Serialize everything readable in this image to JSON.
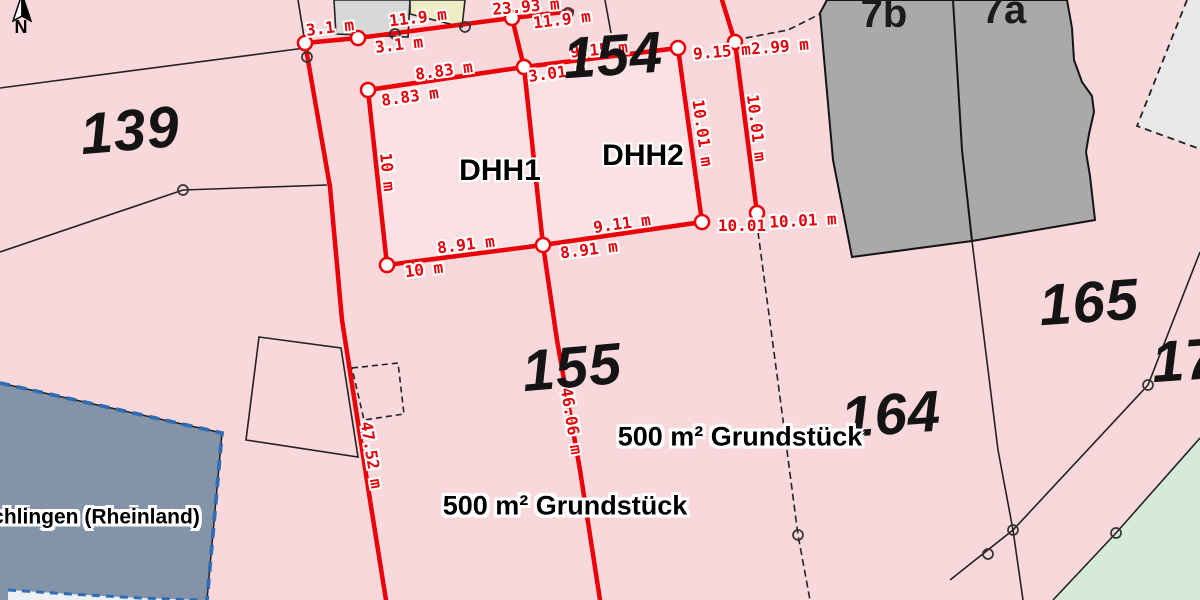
{
  "map": {
    "north_label": "N",
    "colors": {
      "background_pink": "#f9d8db",
      "parcel_highlight_pink": "#fbe1e3",
      "measurement_red": "#e60008",
      "building_gray": "#a9a9a9",
      "small_building_gray": "#d8d8d8",
      "yellow_building": "#ecebc3",
      "dashed_region_gray": "#e8e8e8",
      "green_area": "#d6ead8",
      "municipality_blue_fill": "#8494a8",
      "municipality_blue_border": "#2e6cb6",
      "boundary_black": "#222222",
      "inner_white_shape": "#eef1f3"
    },
    "labels": {
      "measurements": [
        {
          "text": "3.1 m",
          "x": 330,
          "y": 28,
          "rot": -7
        },
        {
          "text": "3.1 m",
          "x": 399,
          "y": 45,
          "rot": -7
        },
        {
          "text": "11.9 m",
          "x": 418,
          "y": 18,
          "rot": -7
        },
        {
          "text": "23.93 m",
          "x": 526,
          "y": 7,
          "rot": -5
        },
        {
          "text": "11.9 m",
          "x": 562,
          "y": 20,
          "rot": -7
        },
        {
          "text": "8.83 m",
          "x": 444,
          "y": 71,
          "rot": -8
        },
        {
          "text": "8.83 m",
          "x": 410,
          "y": 97,
          "rot": -8
        },
        {
          "text": "3.01 m",
          "x": 557,
          "y": 73,
          "rot": -8
        },
        {
          "text": "9.15 m",
          "x": 599,
          "y": 50,
          "rot": -5
        },
        {
          "text": "9.15 m",
          "x": 722,
          "y": 52,
          "rot": -5
        },
        {
          "text": "2.99 m",
          "x": 780,
          "y": 47,
          "rot": -5
        },
        {
          "text": "10 m",
          "x": 387,
          "y": 172,
          "rot": 84
        },
        {
          "text": "10.01 m",
          "x": 702,
          "y": 133,
          "rot": 82
        },
        {
          "text": "10.01 m",
          "x": 756,
          "y": 128,
          "rot": 83
        },
        {
          "text": "9.11 m",
          "x": 622,
          "y": 224,
          "rot": -8
        },
        {
          "text": "8.91 m",
          "x": 466,
          "y": 245,
          "rot": -7
        },
        {
          "text": "8.91 m",
          "x": 589,
          "y": 250,
          "rot": -7
        },
        {
          "text": "10 m",
          "x": 424,
          "y": 270,
          "rot": -7
        },
        {
          "text": "10.01",
          "x": 742,
          "y": 226,
          "rot": 0
        },
        {
          "text": "10.01 m",
          "x": 803,
          "y": 221,
          "rot": -3
        },
        {
          "text": "46.06 m",
          "x": 571,
          "y": 421,
          "rot": 81
        },
        {
          "text": "47.52 m",
          "x": 371,
          "y": 455,
          "rot": 81
        }
      ],
      "parcels": [
        {
          "text": "139",
          "x": 130,
          "y": 131,
          "rot": -5
        },
        {
          "text": "154",
          "x": 613,
          "y": 56,
          "rot": -4
        },
        {
          "text": "155",
          "x": 572,
          "y": 368,
          "rot": -5
        },
        {
          "text": "164",
          "x": 891,
          "y": 415,
          "rot": -4
        },
        {
          "text": "165",
          "x": 1089,
          "y": 303,
          "rot": -4
        },
        {
          "text": "17",
          "x": 1185,
          "y": 361,
          "rot": -4
        }
      ],
      "house_numbers": [
        {
          "text": "7b",
          "x": 884,
          "y": 14,
          "rot": 0
        },
        {
          "text": "7a",
          "x": 1004,
          "y": 10,
          "rot": 0
        }
      ],
      "units": [
        {
          "text": "DHH1",
          "x": 500,
          "y": 171,
          "rot": 0
        },
        {
          "text": "DHH2",
          "x": 643,
          "y": 156,
          "rot": 0
        }
      ],
      "areas": [
        {
          "text": "500 m² Grundstück",
          "x": 740,
          "y": 437,
          "rot": 0
        },
        {
          "text": "500 m² Grundstück",
          "x": 565,
          "y": 506,
          "rot": 0
        }
      ],
      "municipality": [
        {
          "text": "chlingen (Rheinland)",
          "x": 96,
          "y": 517,
          "rot": 0
        }
      ]
    }
  }
}
